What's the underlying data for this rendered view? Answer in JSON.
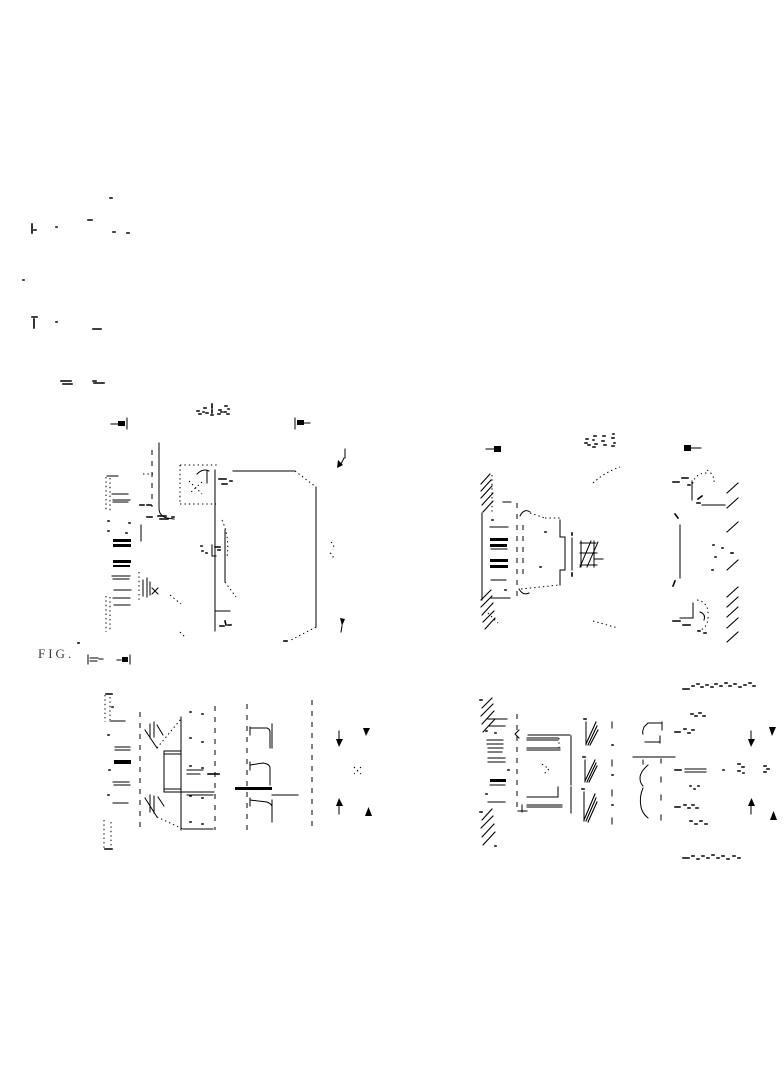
{
  "page": {
    "background_color": "#ffffff",
    "ink_color": "#000000",
    "width_px": 784,
    "height_px": 1066,
    "content_kind": "scanned line drawing sheet, four sectional views"
  },
  "captions": {
    "sheet_caption": "FIG.",
    "figure_top_left_caption": "",
    "figure_top_right_caption": "",
    "figure_bottom_right_caption": ""
  },
  "figures": [
    {
      "name": "top-left-sectional-view",
      "markers": [
        "section-cut-marker-left",
        "section-cut-marker-right",
        "leader-arrow-upper",
        "leader-arrow-lower"
      ]
    },
    {
      "name": "top-right-sectional-view",
      "markers": [
        "section-cut-marker-left",
        "section-cut-marker-right"
      ]
    },
    {
      "name": "bottom-left-sectional-view",
      "markers": [
        "dimension-arrow-inner-top",
        "dimension-arrow-inner-bottom",
        "dimension-arrow-outer-top",
        "dimension-arrow-outer-bottom"
      ]
    },
    {
      "name": "bottom-right-sectional-view",
      "markers": [
        "dimension-arrow-inner-top",
        "dimension-arrow-inner-bottom",
        "dimension-arrow-outer-top",
        "dimension-arrow-outer-bottom"
      ]
    }
  ]
}
